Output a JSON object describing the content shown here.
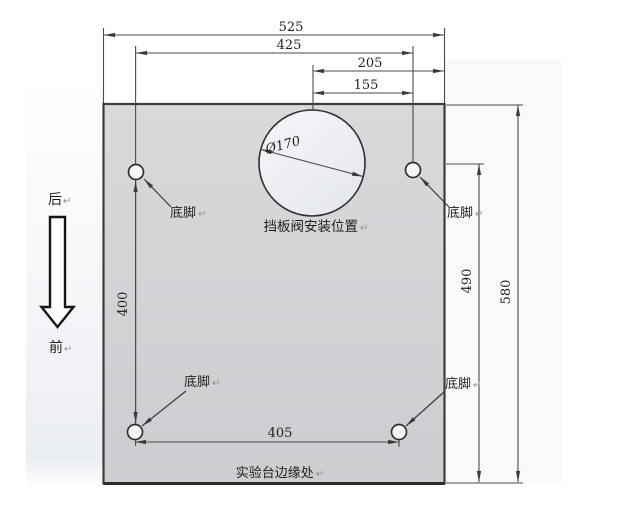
{
  "drawing": {
    "title_context": "mounting-plate-dimension-drawing",
    "dimensions": {
      "total_width": "525",
      "top_holes_span": "425",
      "center_to_right_edge": "205",
      "center_to_right_hole": "155",
      "left_holes_span": "400",
      "bottom_holes_span": "405",
      "right_hole_to_bottom": "490",
      "total_height": "580",
      "valve_hole_diameter": "Ø170"
    },
    "labels": {
      "foot": "底脚",
      "valve_position": "挡板阀安装位置",
      "table_edge": "实验台边缘处",
      "return_mark": "↵"
    },
    "direction": {
      "back": "后",
      "front": "前"
    },
    "colors": {
      "plate_fill": "#d4d5d7",
      "plate_edge": "#3c3c3e",
      "dimension_line": "#4a4a4c",
      "text": "#1f1f1f",
      "hole_fill": "#f5f6f8"
    }
  }
}
